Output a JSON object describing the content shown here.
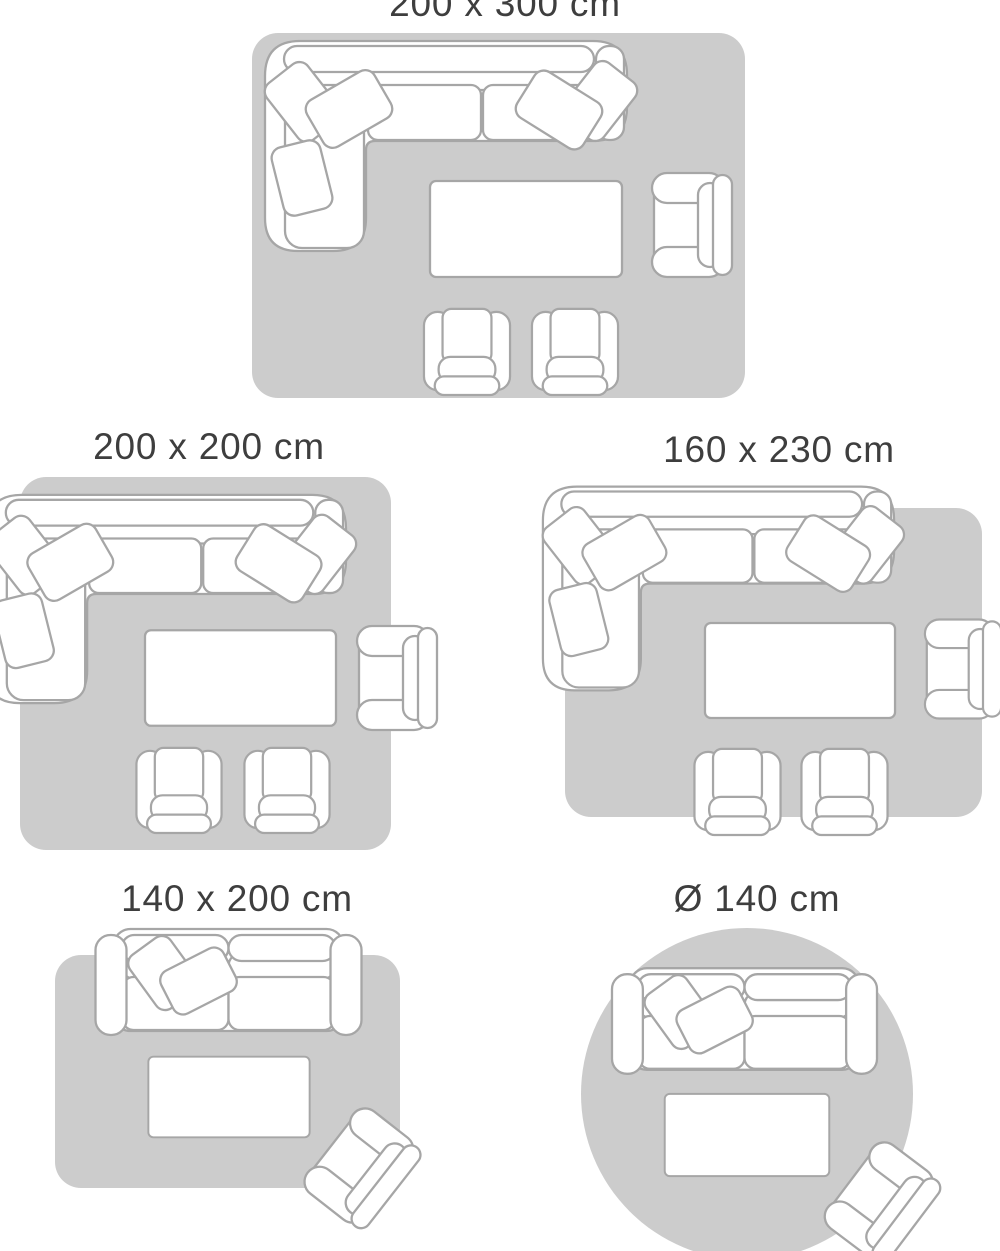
{
  "guide": {
    "name": "Rug size guide",
    "colors": {
      "background": "#ffffff",
      "rug": "#cccccc",
      "furniture_fill": "#ffffff",
      "furniture_outline": "#a6a6a6",
      "label_text": "#3e3e3e"
    },
    "layouts": [
      {
        "id": "200x300",
        "label": "200 x 300 cm",
        "rug_shape": "rectangle",
        "furniture": [
          "corner-sofa",
          "coffee-table",
          "armchair",
          "front-armchair",
          "front-armchair"
        ]
      },
      {
        "id": "200x200",
        "label": "200 x 200 cm",
        "rug_shape": "rectangle",
        "furniture": [
          "corner-sofa",
          "coffee-table",
          "armchair",
          "front-armchair",
          "front-armchair"
        ]
      },
      {
        "id": "160x230",
        "label": "160 x 230 cm",
        "rug_shape": "rectangle",
        "furniture": [
          "corner-sofa",
          "coffee-table",
          "armchair",
          "front-armchair",
          "front-armchair"
        ]
      },
      {
        "id": "140x200",
        "label": "140 x 200 cm",
        "rug_shape": "rectangle",
        "furniture": [
          "two-seat-sofa",
          "coffee-table",
          "rotated-armchair"
        ]
      },
      {
        "id": "diameter-140",
        "label": "Ø 140 cm",
        "rug_shape": "circle",
        "furniture": [
          "two-seat-sofa",
          "coffee-table",
          "rotated-armchair"
        ]
      }
    ]
  }
}
